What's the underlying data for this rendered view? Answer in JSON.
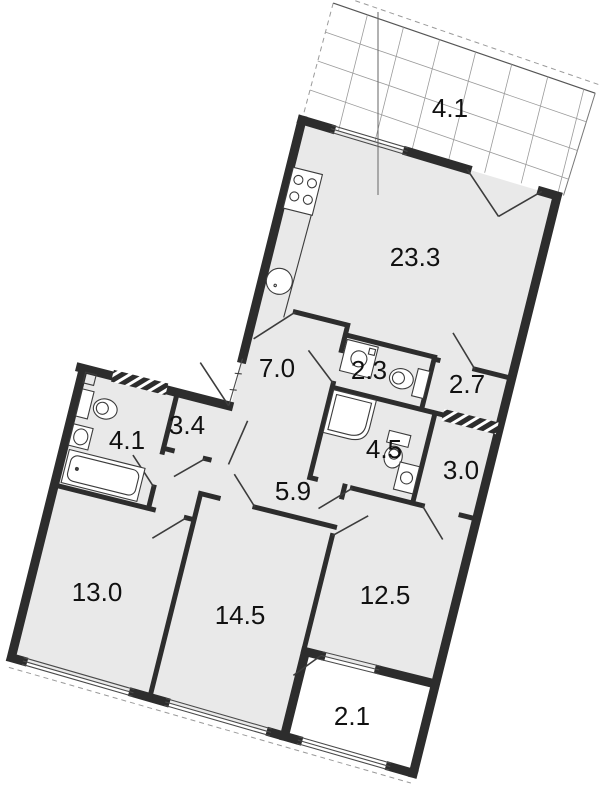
{
  "plan": {
    "type": "apartment-floor-plan",
    "rooms": [
      {
        "id": "balcony-top",
        "name": "balcony",
        "area": "4.1"
      },
      {
        "id": "living-kitchen",
        "name": "kitchen-living",
        "area": "23.3"
      },
      {
        "id": "hall",
        "name": "hall",
        "area": "7.0"
      },
      {
        "id": "wc",
        "name": "wc",
        "area": "2.3"
      },
      {
        "id": "pantry",
        "name": "pantry",
        "area": "2.7"
      },
      {
        "id": "dressing",
        "name": "dressing",
        "area": "3.4"
      },
      {
        "id": "bathroom",
        "name": "bathroom",
        "area": "4.1"
      },
      {
        "id": "shower-wc",
        "name": "shower-wc",
        "area": "4.5"
      },
      {
        "id": "wardrobe",
        "name": "wardrobe",
        "area": "3.0"
      },
      {
        "id": "corridor",
        "name": "corridor",
        "area": "5.9"
      },
      {
        "id": "bedroom-1",
        "name": "bedroom",
        "area": "13.0"
      },
      {
        "id": "bedroom-2",
        "name": "bedroom",
        "area": "14.5"
      },
      {
        "id": "bedroom-3",
        "name": "bedroom",
        "area": "12.5"
      },
      {
        "id": "loggia",
        "name": "loggia",
        "area": "2.1"
      }
    ],
    "colors": {
      "wall": "#2d2d2d",
      "room_fill": "#e9e9e9",
      "background": "#ffffff",
      "label": "#111111",
      "grid_line": "#9a9a9a"
    },
    "icons": [
      "stove-icon",
      "kitchen-sink-icon",
      "toilet-icon",
      "bathtub-icon",
      "shower-tray-icon",
      "washing-machine-icon",
      "wash-basin-icon",
      "vent-shaft-hatch"
    ]
  }
}
